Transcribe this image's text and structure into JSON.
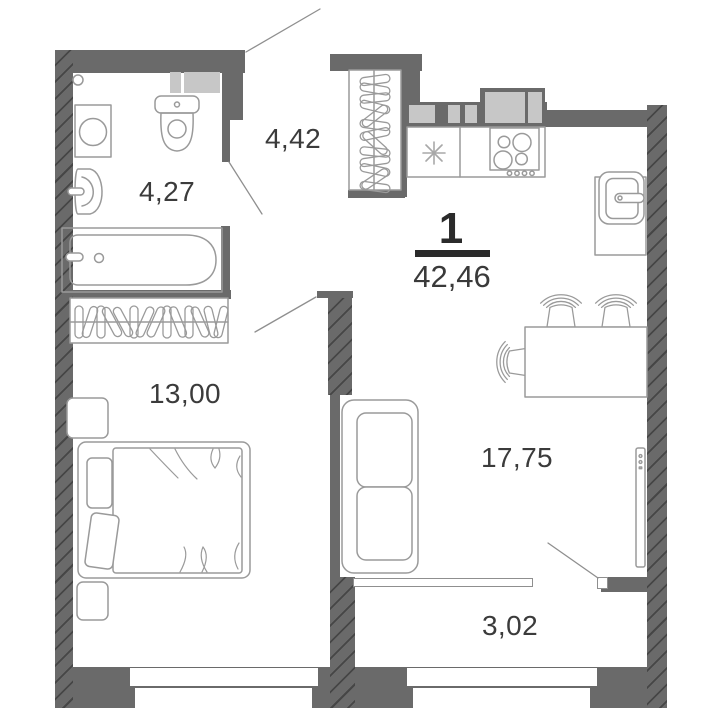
{
  "plan": {
    "apartment": {
      "number": "1",
      "total_area": "42,46"
    },
    "rooms": {
      "hallway": {
        "area": "4,42"
      },
      "bathroom": {
        "area": "4,27"
      },
      "bedroom": {
        "area": "13,00"
      },
      "living_kitchen": {
        "area": "17,75"
      },
      "balcony": {
        "area": "3,02"
      }
    },
    "colors": {
      "wall": "#6a6a6a",
      "wall_hatch": "#4a4a4a",
      "vent_block": "#c7c7c7",
      "furniture_line": "#9a9a9a",
      "label_text": "#3b3b3b",
      "accent_text": "#2b2b2b",
      "background": "#ffffff"
    },
    "icons": [
      "entrance-door-swing",
      "bathroom-door-swing",
      "bedroom-door-swing",
      "balcony-door-swing",
      "floor-drain-icon",
      "washing-machine-icon",
      "toilet-icon",
      "washbasin-icon",
      "bathtub-icon",
      "wardrobe-hangers-icon",
      "kitchen-sink-icon",
      "stove-icon",
      "fridge-icon",
      "dining-table-icon",
      "chair-icon",
      "sofa-icon",
      "bed-icon",
      "nightstand-icon",
      "tv-icon",
      "window-icon"
    ]
  }
}
